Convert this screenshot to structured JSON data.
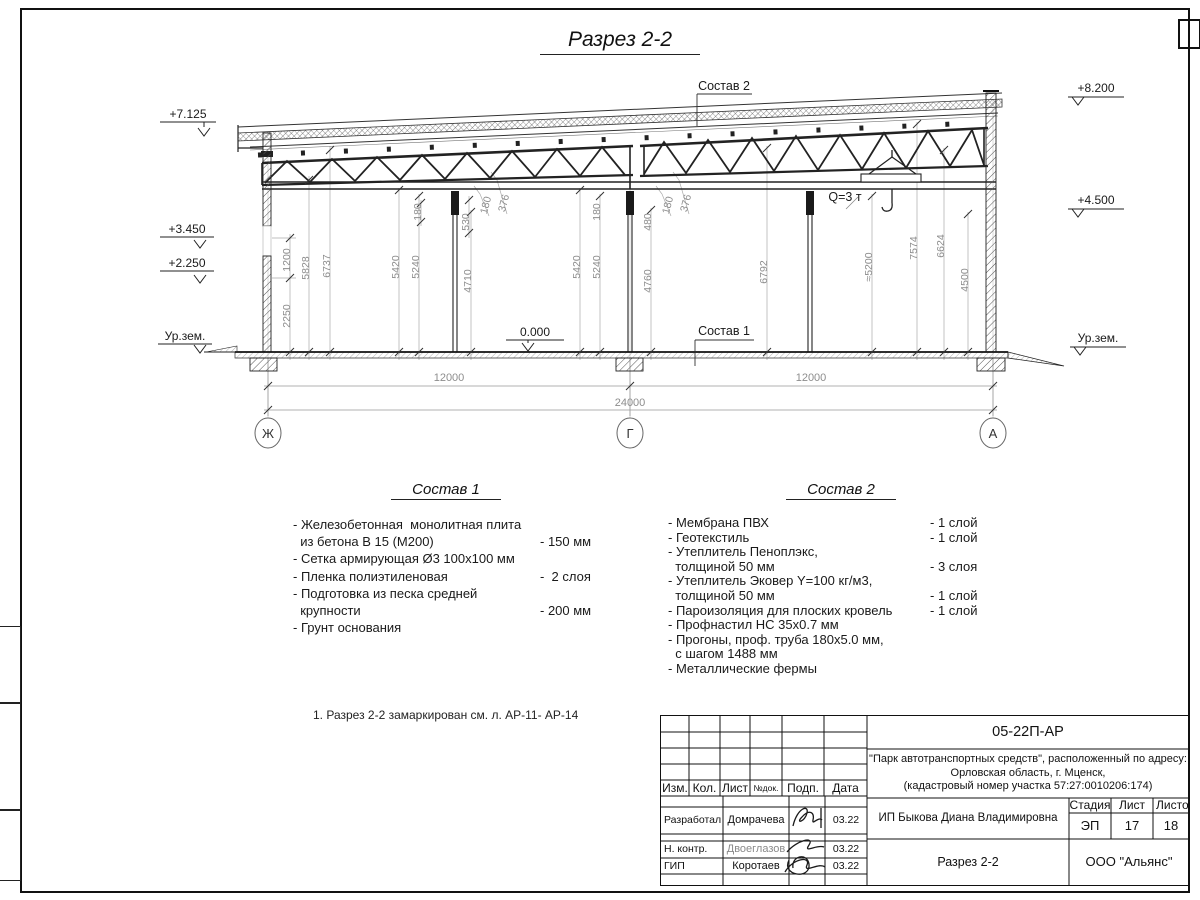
{
  "sheet": {
    "title": "Разрез 2-2",
    "note": "1. Разрез 2-2 замаркирован см. л. АР-11- АР-14"
  },
  "drawing": {
    "elevations": {
      "left": [
        "+7.125",
        "+3.450",
        "+2.250",
        "Ур.зем."
      ],
      "right": [
        "+8.200",
        "+4.500",
        "Ур.зем."
      ],
      "floor": "0.000"
    },
    "labels": {
      "sostav2_ref": "Состав 2",
      "sostav1_ref": "Состав 1",
      "crane": "Q=3 т"
    },
    "dims": {
      "v": [
        "1200",
        "2250",
        "5828",
        "6737",
        "5420",
        "5240",
        "180",
        "530",
        "180",
        "376",
        "4710",
        "5420",
        "5240",
        "180",
        "480",
        "180",
        "376",
        "4760",
        "6792",
        "≈5200",
        "7574",
        "6624",
        "4500"
      ],
      "h": [
        "12000",
        "12000",
        "24000"
      ],
      "axes": [
        "Ж",
        "Г",
        "А"
      ]
    }
  },
  "sostav1": {
    "heading": "Состав 1",
    "rows": [
      {
        "t": "- Железобетонная  монолитная плита",
        "v": ""
      },
      {
        "t": "  из бетона В 15 (М200)",
        "v": "- 150 мм"
      },
      {
        "t": "- Сетка армирующая Ø3 100х100 мм",
        "v": ""
      },
      {
        "t": "- Пленка полиэтиленовая",
        "v": "-  2 слоя"
      },
      {
        "t": "- Подготовка из песка средней",
        "v": ""
      },
      {
        "t": "  крупности",
        "v": "- 200 мм"
      },
      {
        "t": "- Грунт основания",
        "v": ""
      }
    ]
  },
  "sostav2": {
    "heading": "Состав 2",
    "rows": [
      {
        "t": "- Мембрана ПВХ",
        "v": "- 1 слой"
      },
      {
        "t": "- Геотекстиль",
        "v": "- 1 слой"
      },
      {
        "t": "- Утеплитель Пеноплэкс,",
        "v": ""
      },
      {
        "t": "  толщиной 50 мм",
        "v": "- 3 слоя"
      },
      {
        "t": "- Утеплитель Эковер Y=100 кг/м3,",
        "v": ""
      },
      {
        "t": "  толщиной 50 мм",
        "v": "- 1 слой"
      },
      {
        "t": "- Пароизоляция для плоских кровель",
        "v": "- 1 слой"
      },
      {
        "t": "- Профнастил НС 35х0.7 мм",
        "v": ""
      },
      {
        "t": "- Прогоны, проф. труба 180х5.0 мм,",
        "v": ""
      },
      {
        "t": "  с шагом 1488 мм",
        "v": ""
      },
      {
        "t": "- Металлические фермы",
        "v": ""
      }
    ]
  },
  "titleblock": {
    "doc_number": "05-22П-АР",
    "project_lines": [
      "\"Парк автотранспортных средств\",  расположенный по адресу:",
      "Орловская область, г. Мценск,",
      "(кадастровый номер участка 57:27:0010206:174)"
    ],
    "client": "ИП Быкова Диана Владимировна",
    "sheet_name": "Разрез 2-2",
    "company": "ООО \"Альянс\"",
    "header_cols": [
      "Изм.",
      "Кол.",
      "Лист",
      "№док.",
      "Подп.",
      "Дата"
    ],
    "sign_rows": [
      {
        "role": "Разработал",
        "name": "Домрачева",
        "date": "03.22"
      },
      {
        "role": "Н. контр.",
        "name": "Двоеглазов",
        "date": "03.22"
      },
      {
        "role": "ГИП",
        "name": "Коротаев",
        "date": "03.22"
      }
    ],
    "stage_cols": [
      {
        "label": "Стадия",
        "value": "ЭП"
      },
      {
        "label": "Лист",
        "value": "17"
      },
      {
        "label": "Листов",
        "value": "18"
      }
    ]
  }
}
